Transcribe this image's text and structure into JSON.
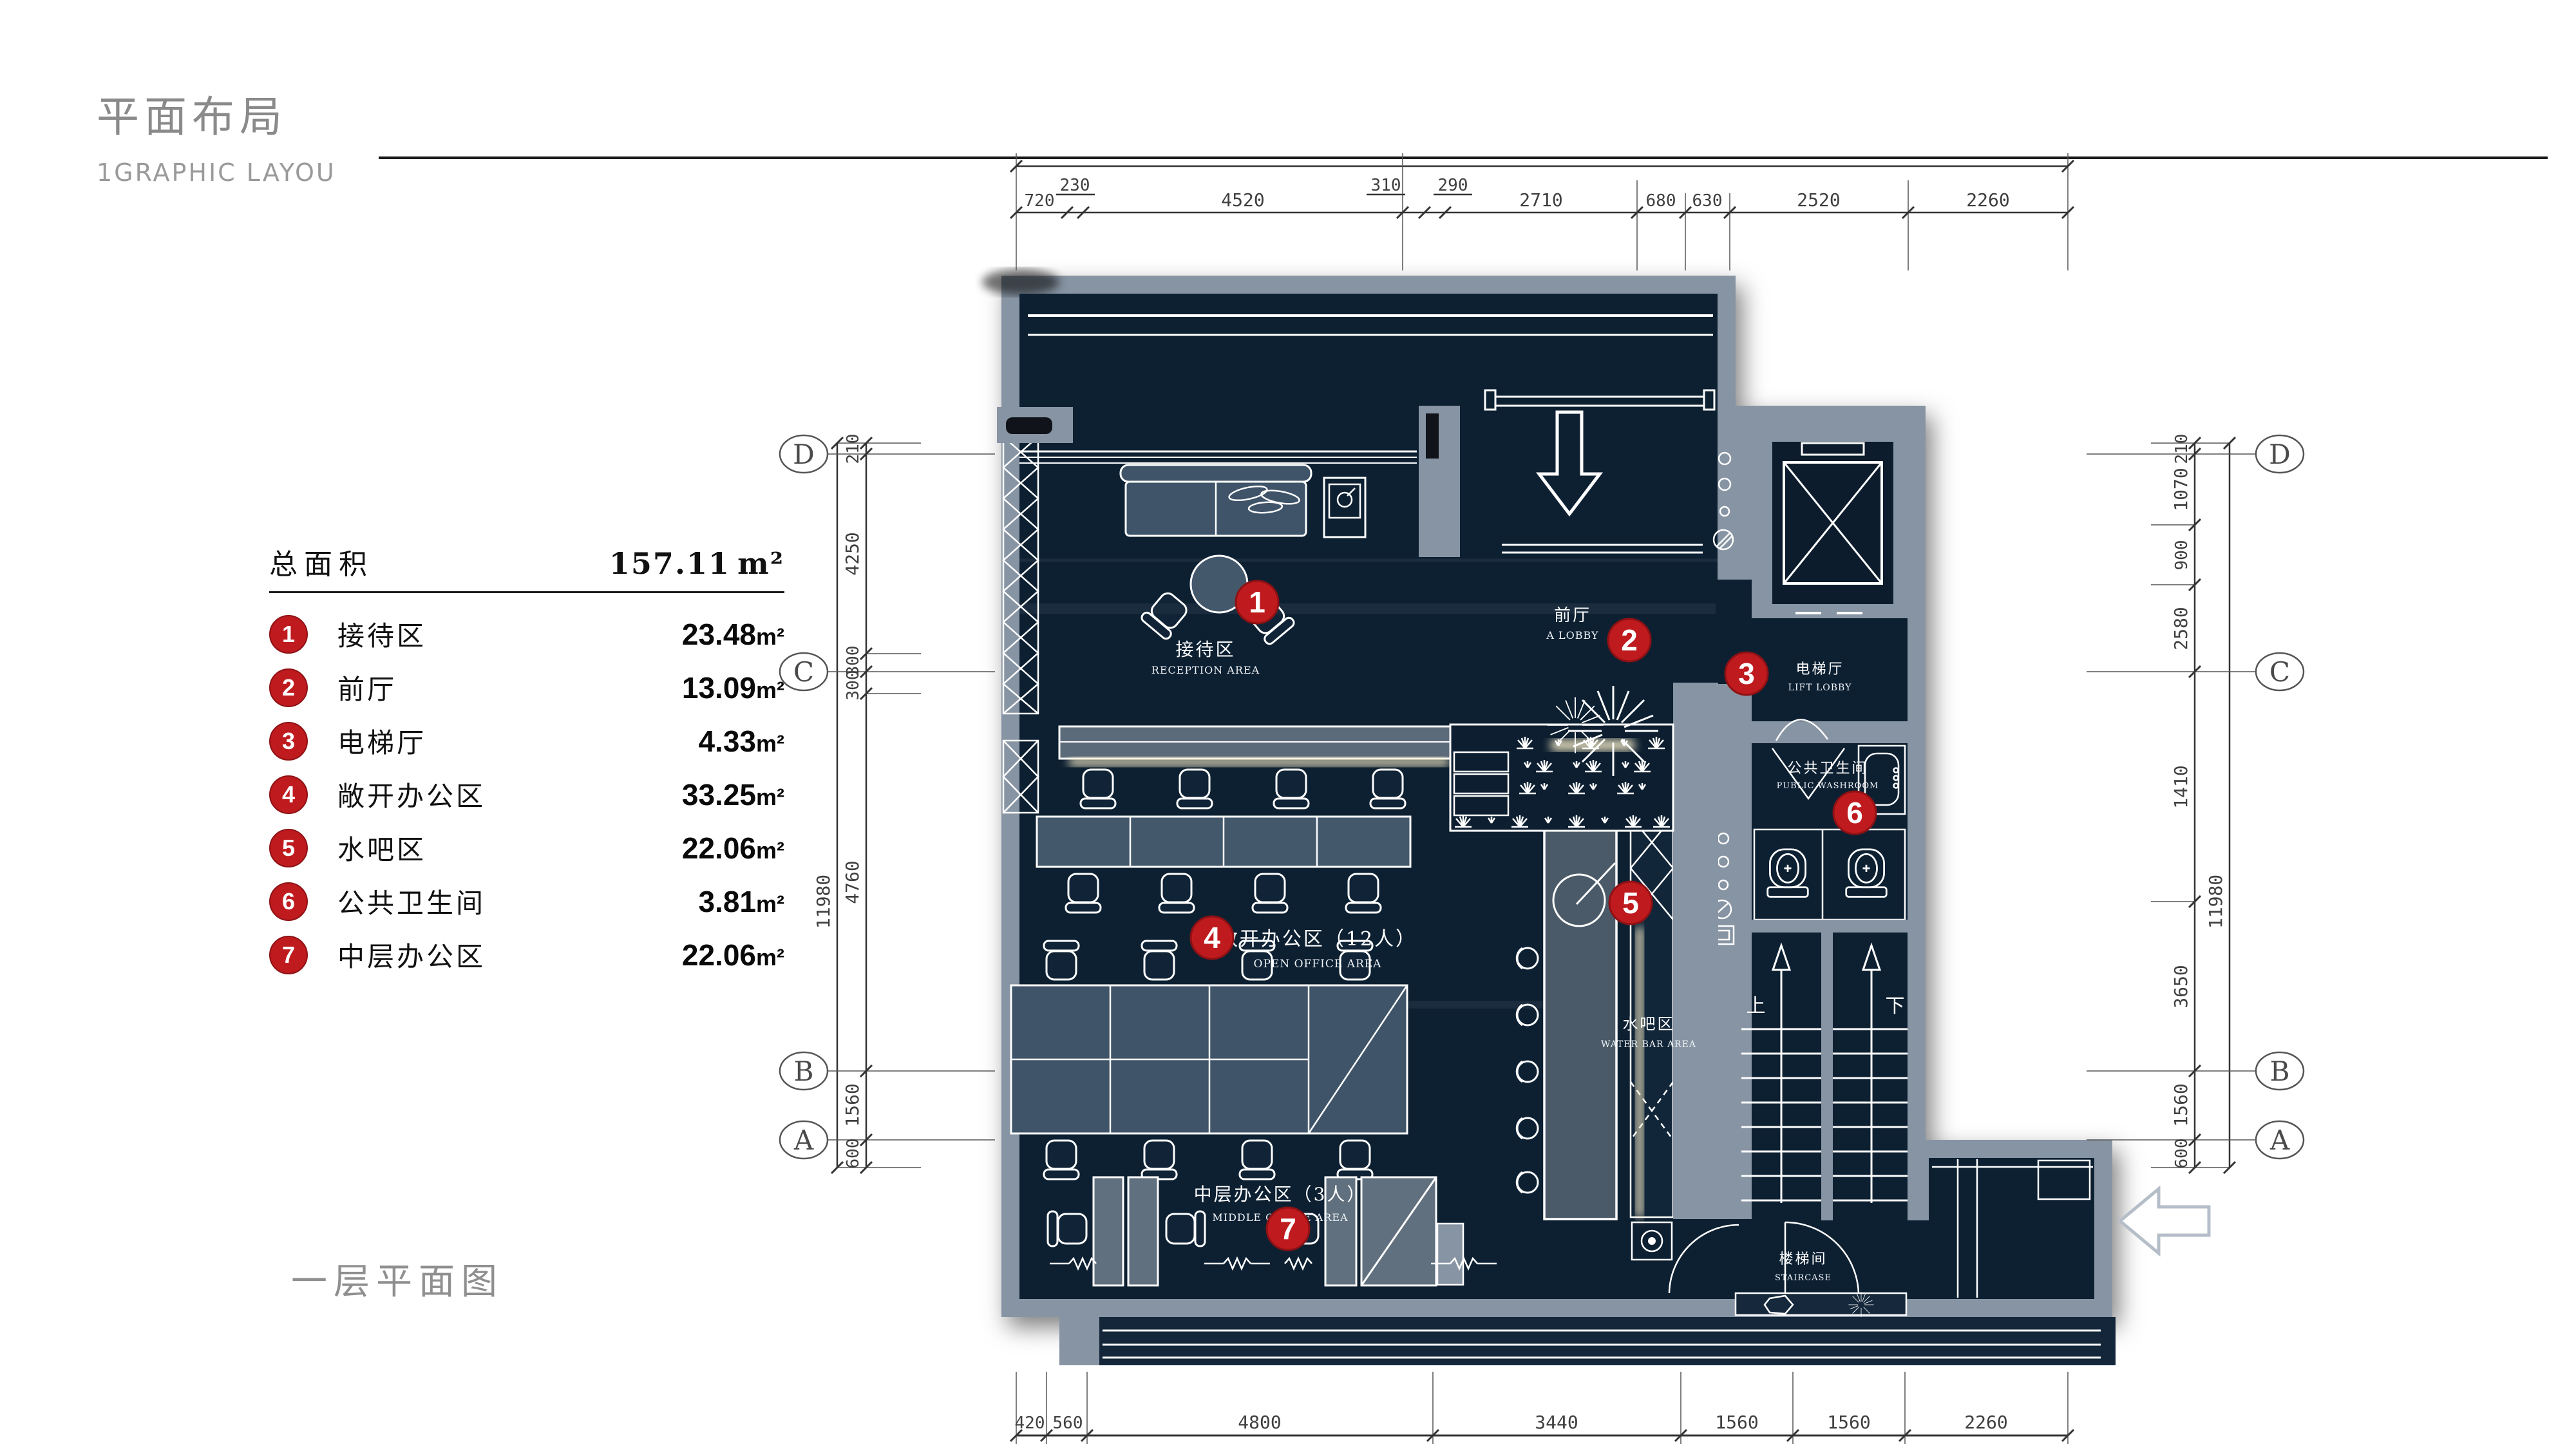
{
  "header": {
    "title": "平面布局",
    "subtitle": "1GRAPHIC LAYOU"
  },
  "caption": "一层平面图",
  "legend": {
    "total_label": "总面积",
    "total_value": "157.11",
    "unit": "m²",
    "items": [
      {
        "num": "1",
        "name": "接待区",
        "area": "23.48"
      },
      {
        "num": "2",
        "name": "前厅",
        "area": "13.09"
      },
      {
        "num": "3",
        "name": "电梯厅",
        "area": "4.33"
      },
      {
        "num": "4",
        "name": "敞开办公区",
        "area": "33.25"
      },
      {
        "num": "5",
        "name": "水吧区",
        "area": "22.06"
      },
      {
        "num": "6",
        "name": "公共卫生间",
        "area": "3.81"
      },
      {
        "num": "7",
        "name": "中层办公区",
        "area": "22.06"
      }
    ]
  },
  "plan": {
    "grid": [
      "D",
      "C",
      "B",
      "A"
    ],
    "dims": {
      "top": [
        "720",
        "230",
        "4520",
        "310",
        "290",
        "2710",
        "680",
        "630",
        "2520",
        "2260"
      ],
      "bottom": [
        "420",
        "560",
        "4800",
        "3440",
        "1560",
        "1560",
        "2260"
      ],
      "left": [
        "210",
        "4250",
        "300",
        "300",
        "4760",
        "1560",
        "600"
      ],
      "left_total": "11980",
      "right": [
        "210",
        "1070",
        "900",
        "2580",
        "1410",
        "3650",
        "1560",
        "600"
      ],
      "right_total": "11980"
    },
    "rooms": [
      {
        "num": "1",
        "zh": "接待区",
        "en": "RECEPTION AREA"
      },
      {
        "num": "2",
        "zh": "前厅",
        "en": "A LOBBY"
      },
      {
        "num": "3",
        "zh": "电梯厅",
        "en": "LIFT LOBBY"
      },
      {
        "num": "4",
        "zh": "敞开办公区（12人）",
        "en": "OPEN OFFICE AREA"
      },
      {
        "num": "5",
        "zh": "水吧区",
        "en": "WATER BAR AREA"
      },
      {
        "num": "6",
        "zh": "公共卫生间",
        "en": "PUBLIC WASHROOM"
      },
      {
        "num": "7",
        "zh": "中层办公区（3人）",
        "en": "MIDDLE OFFICE AREA"
      }
    ],
    "stairs": {
      "room_zh": "楼梯间",
      "room_en": "STAIRCASE",
      "up": "上",
      "down": "下"
    }
  },
  "colors": {
    "accent_red": "#bf1b1f",
    "wall_gray": "#8794a3",
    "floor_navy": "#0d2032",
    "glow": "#f2e8c4"
  }
}
